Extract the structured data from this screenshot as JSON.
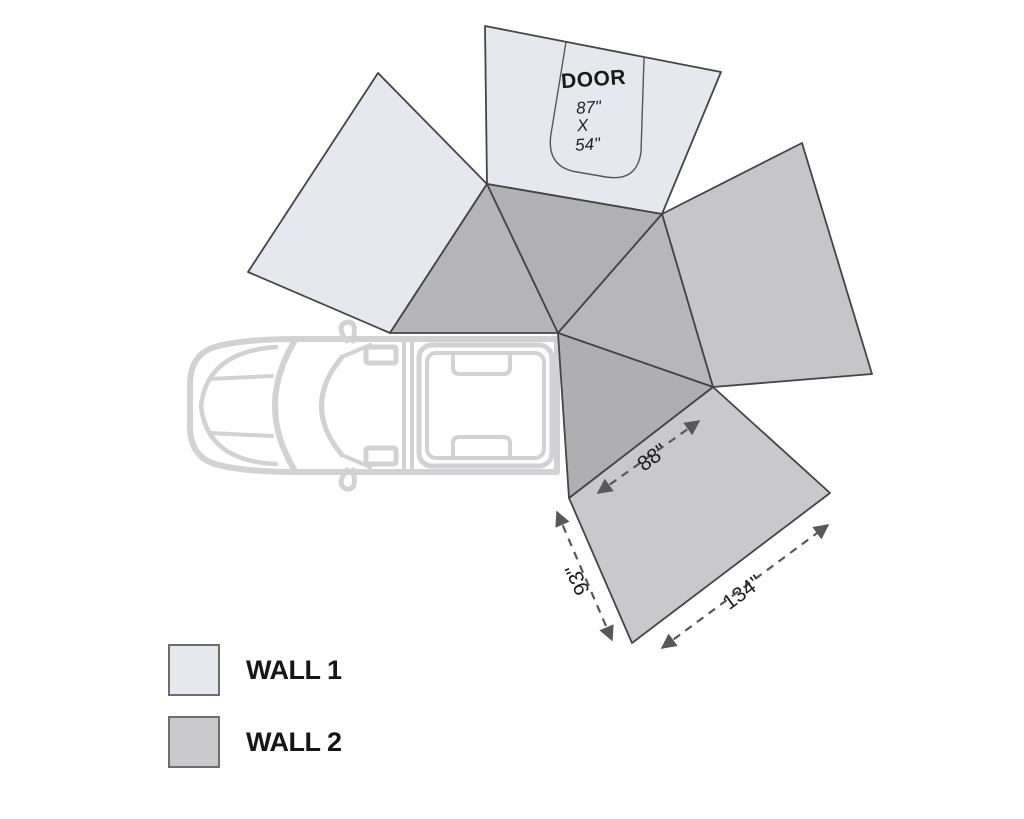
{
  "diagram": {
    "door": {
      "title": "DOOR",
      "dim_width": "87\"",
      "dim_sep": "X",
      "dim_height": "54\""
    },
    "measurements": {
      "edge_88": "88\"",
      "edge_93": "93\"",
      "edge_134": "134\""
    }
  },
  "legend": {
    "items": [
      {
        "label": "WALL 1",
        "color": "#e7e8ed"
      },
      {
        "label": "WALL 2",
        "color": "#c9c9cb"
      }
    ]
  },
  "colors": {
    "wall1": "#e7e8ed",
    "wall2_right": "#c6c6c8",
    "wall2_bottom": "#c9c9cb",
    "canopy_left": "#b5b5b7",
    "canopy_top": "#b1b1b3",
    "canopy_right": "#b7b7b9",
    "canopy_bottom": "#afafb1",
    "panel_outline": "#44444a",
    "dimension_arrow": "#58585a",
    "vehicle_outline": "#d2d2d4"
  }
}
